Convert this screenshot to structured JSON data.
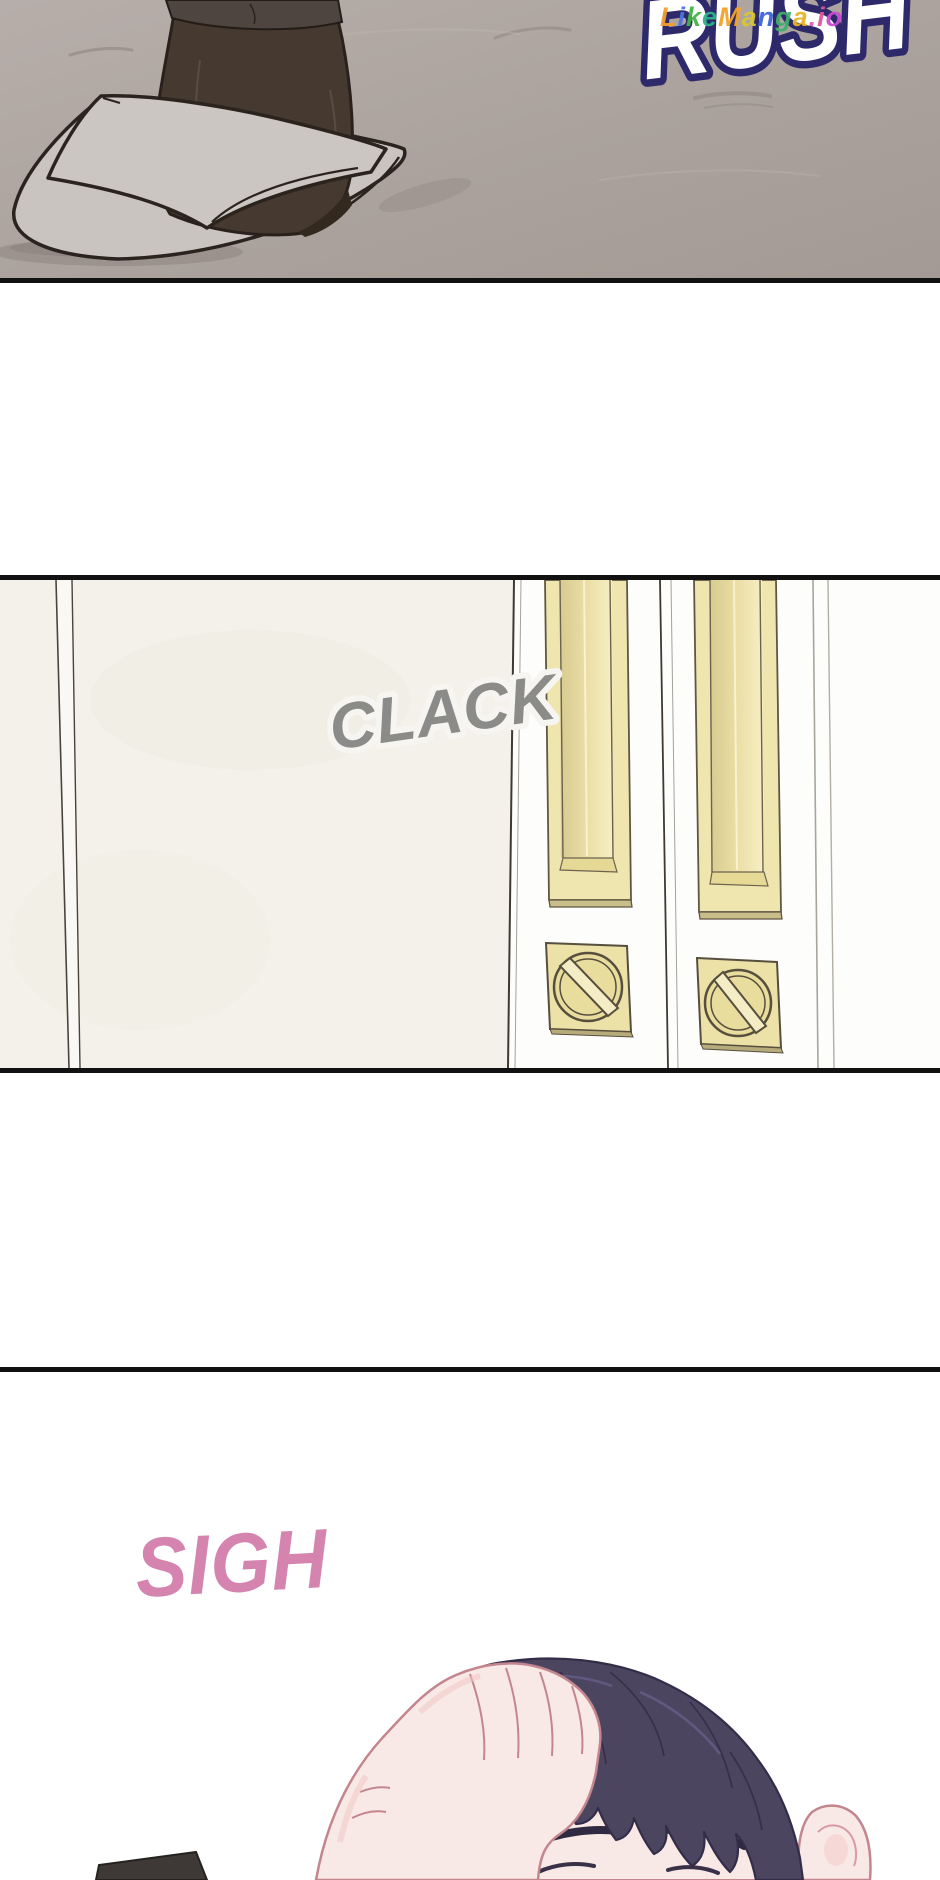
{
  "page": {
    "kind": "webtoon comic page",
    "background_color": "#ffffff",
    "panel_border_color": "#111111"
  },
  "watermark": {
    "text": "LikeManga.io",
    "letters": [
      {
        "ch": "L",
        "color": "#f59f2e"
      },
      {
        "ch": "i",
        "color": "#4a74e8"
      },
      {
        "ch": "k",
        "color": "#43b545"
      },
      {
        "ch": "e",
        "color": "#2cb287"
      },
      {
        "ch": "M",
        "color": "#f5a226"
      },
      {
        "ch": "a",
        "color": "#d9c72f"
      },
      {
        "ch": "n",
        "color": "#3f64d8"
      },
      {
        "ch": "g",
        "color": "#3db06c"
      },
      {
        "ch": "a",
        "color": "#e8b42a"
      },
      {
        "ch": ".",
        "color": "#e060b8"
      },
      {
        "ch": "i",
        "color": "#e2559e"
      },
      {
        "ch": "o",
        "color": "#c94ad2"
      }
    ]
  },
  "panels": [
    {
      "name": "hallway floor with slippered foot",
      "sfx": "RUSH",
      "sfx_fill": "#ffffff",
      "sfx_outline": "#2d296b",
      "floor_color": "#aba29d",
      "slipper_color": "#cbc6c2",
      "sock_color": "#46392f"
    },
    {
      "name": "sliding doors with recessed pulls and thumb-turn locks",
      "sfx": "CLACK",
      "sfx_color": "#8b8b89",
      "door_color": "#f4f1ea",
      "handle_color": "#efe5ae",
      "wall_color": "#fdfdfc"
    },
    {
      "name": "close-up, hand resting on dark hair",
      "sfx": "SIGH",
      "sfx_color": "#d584af",
      "hair_color": "#4c4560",
      "skin_color": "#f9e9e6"
    }
  ]
}
